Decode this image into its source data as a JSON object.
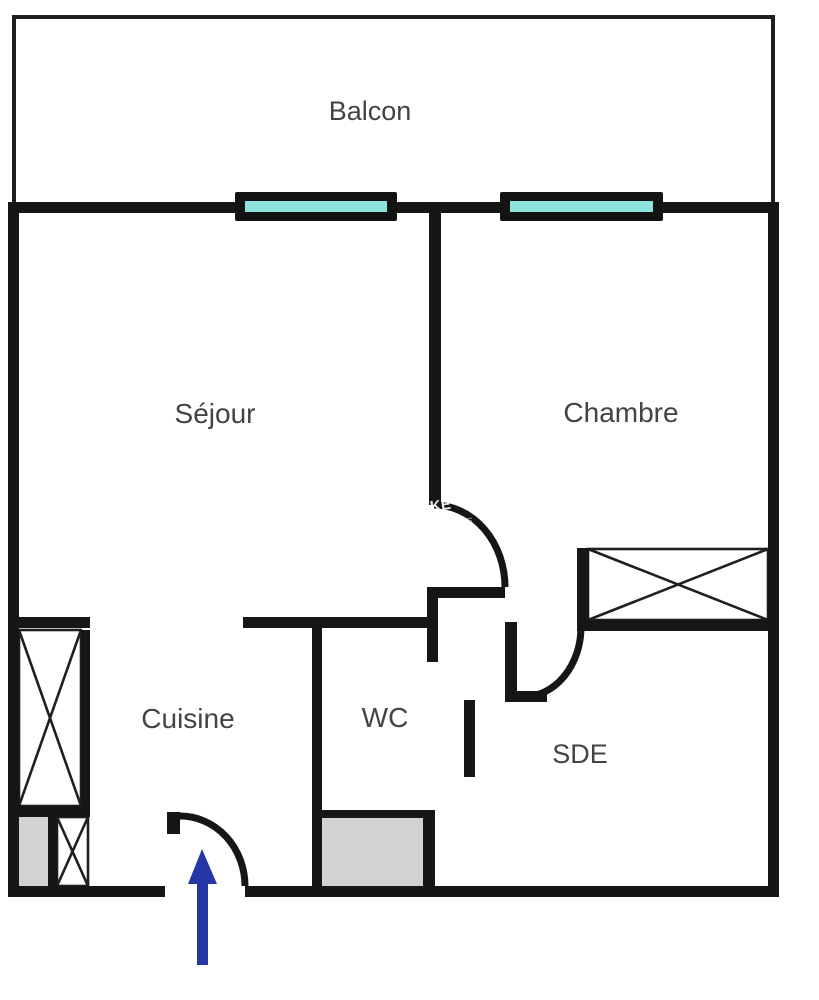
{
  "page": {
    "title": "Plan d'appartement",
    "background": "#ffffff"
  },
  "colors": {
    "wall": "#161616",
    "thin_line": "#1f1f1f",
    "label_text": "#434343",
    "window_glass": "#8ce4dd",
    "window_frame": "#131313",
    "shaft_gray": "#d2d2d2",
    "arrow_blue": "#2636a4",
    "watermark_white": "#ffffff",
    "background": "#ffffff"
  },
  "rooms": [
    {
      "id": "balcon",
      "label": "Balcon",
      "x": 370,
      "y": 120,
      "font": 27
    },
    {
      "id": "sejour",
      "label": "Séjour",
      "x": 215,
      "y": 423,
      "font": 28
    },
    {
      "id": "chambre",
      "label": "Chambre",
      "x": 621,
      "y": 422,
      "font": 28
    },
    {
      "id": "cuisine",
      "label": "Cuisine",
      "x": 188,
      "y": 728,
      "font": 28
    },
    {
      "id": "wc",
      "label": "WC",
      "x": 385,
      "y": 727,
      "font": 28
    },
    {
      "id": "sde",
      "label": "SDE",
      "x": 580,
      "y": 763,
      "font": 27
    }
  ],
  "watermark": {
    "text": "NKE",
    "x": 420,
    "y": 513,
    "rotate": -8,
    "font": 15,
    "opacity": 0.92,
    "fragment_text": "ANKE",
    "fragment_x": 448,
    "fragment_y": 528,
    "fragment_rotate": -10,
    "fragment_font": 9,
    "fragment_opacity": 0.55
  },
  "floorplan": {
    "canvas": {
      "width": 819,
      "height": 1000
    },
    "balcony_lines": [
      {
        "name": "balcony-top-line",
        "r": [
          12,
          15,
          763,
          4
        ]
      },
      {
        "name": "balcony-left-line",
        "r": [
          12,
          15,
          4,
          192
        ]
      },
      {
        "name": "balcony-right-line",
        "r": [
          771,
          15,
          4,
          192
        ]
      }
    ],
    "walls": [
      {
        "name": "top-wall",
        "r": [
          8,
          202,
          771,
          11
        ]
      },
      {
        "name": "left-wall",
        "r": [
          8,
          202,
          11,
          695
        ]
      },
      {
        "name": "right-wall",
        "r": [
          768,
          202,
          11,
          695
        ]
      },
      {
        "name": "bottom-wall-left",
        "r": [
          8,
          886,
          157,
          11
        ]
      },
      {
        "name": "bottom-wall-right",
        "r": [
          245,
          886,
          534,
          11
        ]
      },
      {
        "name": "sejour-chambre-wall",
        "r": [
          429,
          213,
          12,
          292
        ]
      },
      {
        "name": "hall-wall-horizontal",
        "r": [
          427,
          587,
          78,
          11
        ]
      },
      {
        "name": "hall-jamb-vertical",
        "r": [
          427,
          587,
          11,
          75
        ]
      },
      {
        "name": "wc-top-wall",
        "r": [
          243,
          617,
          195,
          11
        ]
      },
      {
        "name": "cuisine-top-wall",
        "r": [
          8,
          617,
          82,
          11
        ]
      },
      {
        "name": "wc-left-wall",
        "r": [
          312,
          617,
          10,
          280
        ]
      },
      {
        "name": "sde-corner-wall-vertical",
        "r": [
          505,
          622,
          12,
          80
        ]
      },
      {
        "name": "sde-corner-wall-horizontal",
        "r": [
          505,
          691,
          42,
          11
        ]
      },
      {
        "name": "chambre-closet-wall",
        "r": [
          577,
          548,
          12,
          83
        ]
      },
      {
        "name": "chambre-bottom-wall",
        "r": [
          586,
          620,
          182,
          11
        ]
      },
      {
        "name": "wc-door-leaf",
        "r": [
          464,
          700,
          11,
          77
        ]
      },
      {
        "name": "shaft-right-wall",
        "r": [
          423,
          810,
          12,
          87
        ]
      },
      {
        "name": "shaft-top-wall",
        "r": [
          322,
          810,
          101,
          8
        ]
      },
      {
        "name": "cuisine-closet-bottom-wall",
        "r": [
          8,
          806,
          82,
          11
        ]
      },
      {
        "name": "cuisine-closet-right-wall",
        "r": [
          81,
          630,
          9,
          183
        ]
      },
      {
        "name": "cuisine-shaft-divider",
        "r": [
          48,
          817,
          9,
          74
        ]
      },
      {
        "name": "entrance-door-leaf",
        "r": [
          167,
          812,
          13,
          22
        ]
      }
    ],
    "gray_boxes": [
      {
        "name": "wc-shaft-box",
        "r": [
          322,
          818,
          101,
          68
        ]
      },
      {
        "name": "cuisine-shaft-box",
        "r": [
          17,
          817,
          31,
          70
        ]
      }
    ],
    "x_boxes": [
      {
        "name": "cuisine-closet-xbox",
        "r": [
          19,
          630,
          62,
          176
        ]
      },
      {
        "name": "cuisine-shaft-closet-xbox",
        "r": [
          57,
          817,
          31,
          69
        ]
      },
      {
        "name": "chambre-closet-xbox",
        "r": [
          588,
          549,
          180,
          71
        ]
      }
    ],
    "windows": [
      {
        "name": "window-sejour",
        "frame": [
          235,
          192,
          162,
          29
        ],
        "glass": [
          245,
          201,
          142,
          11
        ]
      },
      {
        "name": "window-chambre",
        "frame": [
          500,
          192,
          163,
          29
        ],
        "glass": [
          510,
          201,
          143,
          11
        ]
      }
    ],
    "door_arcs": [
      {
        "name": "chambre-door-arc",
        "d": "M 434 505 A 71 82 0 0 1 505 587"
      },
      {
        "name": "sde-door-arc",
        "d": "M 581 627 A 58 70 0 0 1 523 697"
      },
      {
        "name": "entrance-door-arc",
        "d": "M 180 816 A 65 70 0 0 1 245 886"
      }
    ],
    "arrow": {
      "name": "entrance-arrow",
      "head": [
        [
          202,
          849
        ],
        [
          188,
          884
        ],
        [
          217,
          884
        ]
      ],
      "shaft": [
        197,
        880,
        11,
        85
      ]
    }
  }
}
